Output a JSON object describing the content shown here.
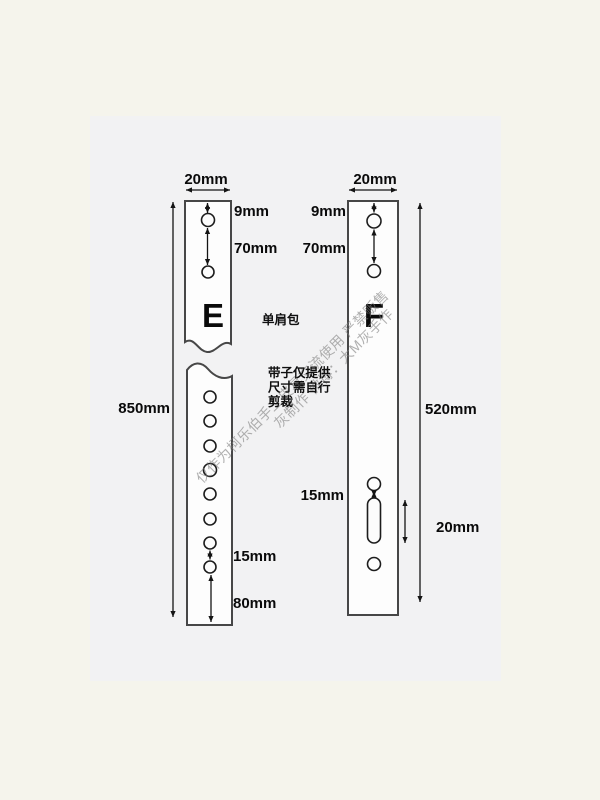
{
  "image": {
    "category_label": "单肩包",
    "cut_note": [
      "带子仅提供",
      "尺寸需自行",
      "剪裁"
    ],
    "straps": {
      "e": {
        "label": "E",
        "width": "20mm",
        "top_hole_offset": "9mm",
        "top_hole_spacing": "70mm",
        "length": "850mm",
        "bottom_hole_spacing": "15mm",
        "bottom_end_offset": "80mm"
      },
      "f": {
        "label": "F",
        "width": "20mm",
        "top_hole_offset": "9mm",
        "top_hole_spacing": "70mm",
        "length": "520mm",
        "slot_gap": "15mm",
        "slot_length": "20mm"
      }
    },
    "watermark": {
      "line1": "仅作为柯乐伯手工皮具交流使用 严禁贩售",
      "line2": "灰制作 微博：大M灰手作"
    },
    "colors": {
      "outer_bg": "#f5f4ec",
      "inner_bg": "#f2f2f3",
      "strap_fill": "#fdfdfd",
      "line": "#141414",
      "text": "#0a0a0a",
      "watermark": "#7e7e7e"
    }
  }
}
